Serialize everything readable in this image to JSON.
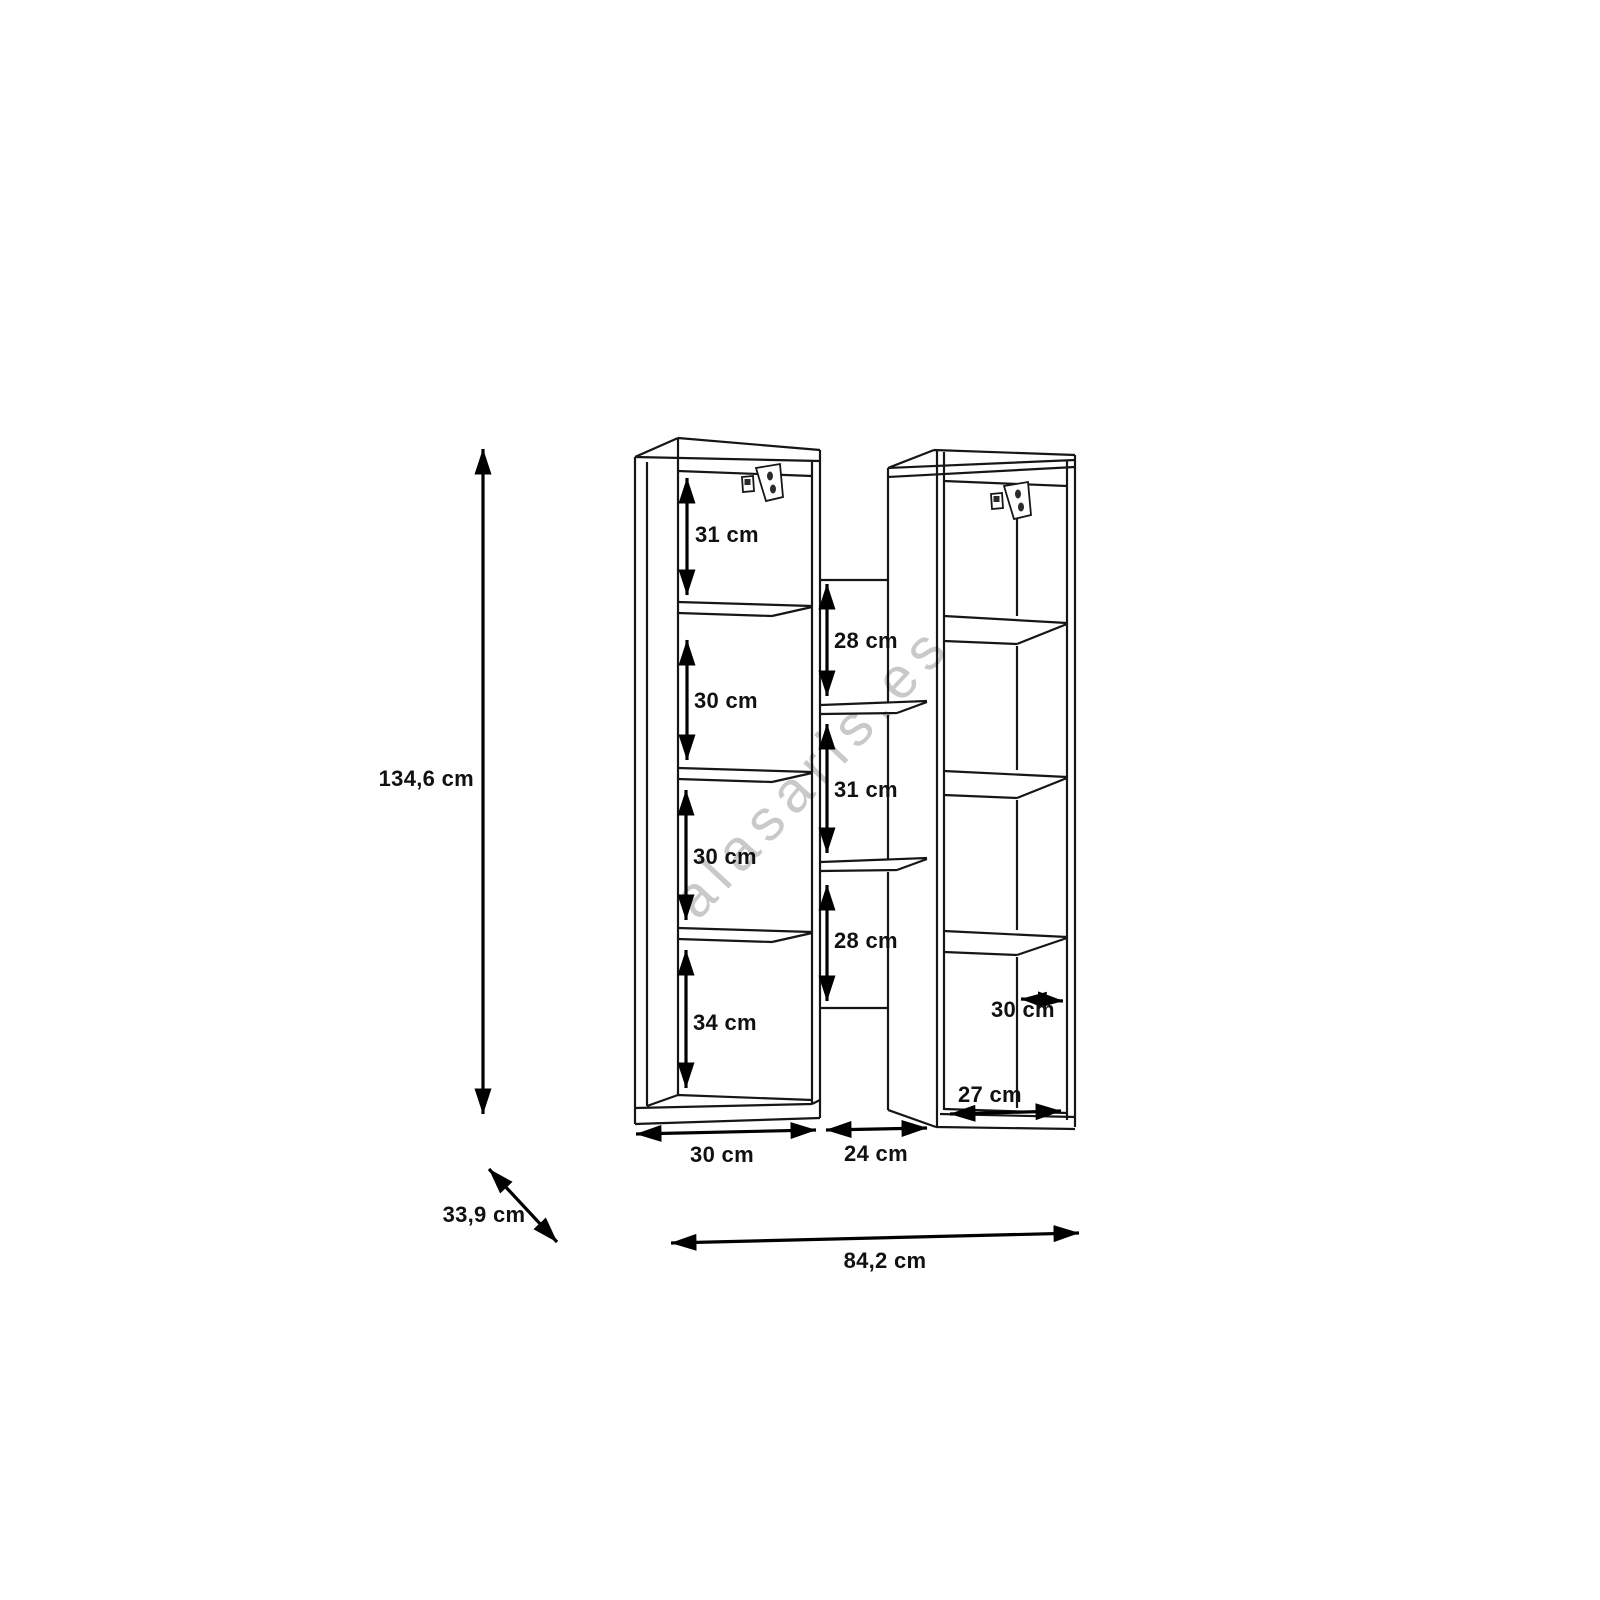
{
  "watermark_text": "alasaris.es",
  "dimensions": {
    "total_height": "134,6 cm",
    "total_depth": "33,9 cm",
    "total_width": "84,2 cm",
    "left_column": {
      "compartments": [
        "31 cm",
        "30 cm",
        "30 cm",
        "34 cm"
      ],
      "width": "30 cm"
    },
    "middle_column": {
      "compartments": [
        "28 cm",
        "31 cm",
        "28 cm"
      ],
      "width": "24 cm"
    },
    "right_column": {
      "shelf_width": "30 cm",
      "width": "27 cm"
    }
  }
}
